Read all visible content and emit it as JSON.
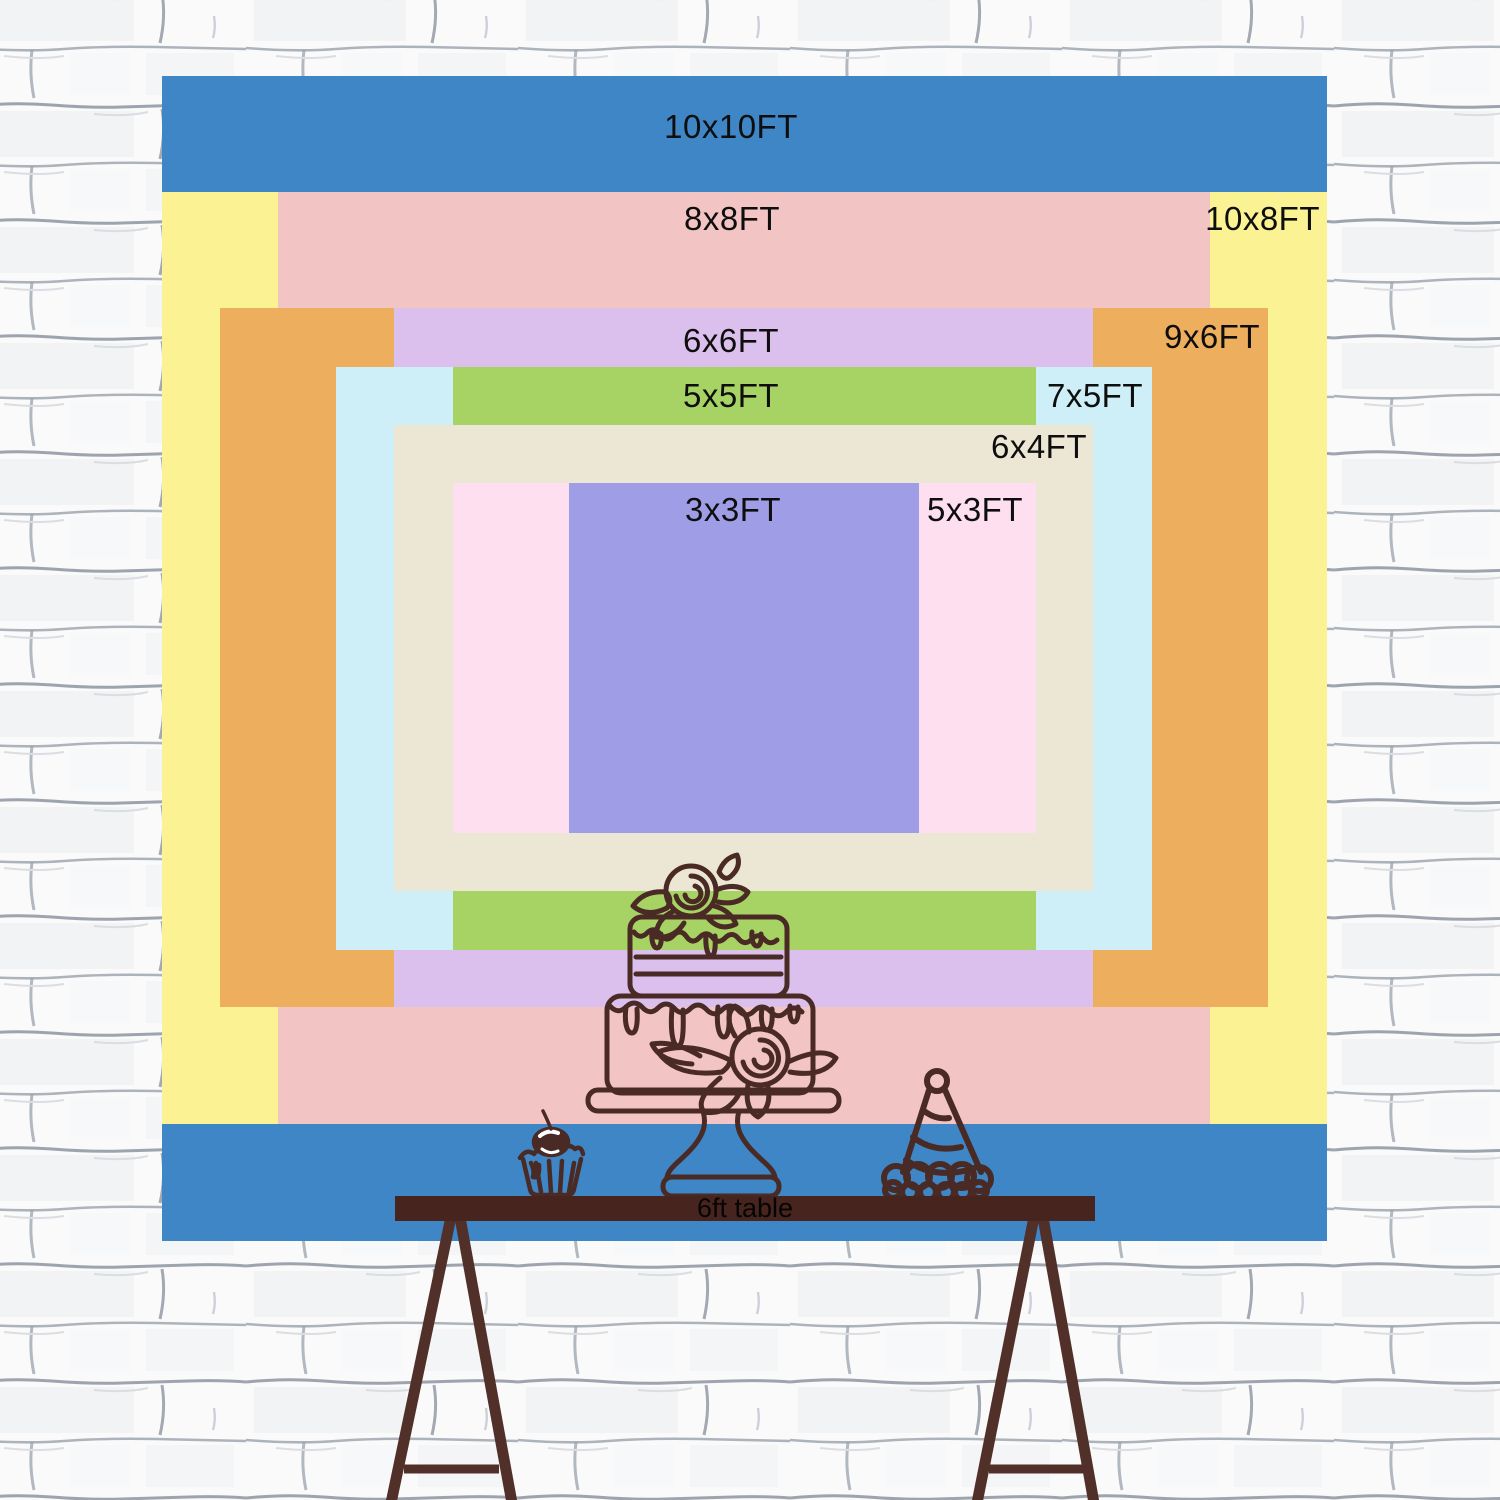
{
  "backdrop_chart": {
    "unit": "FT",
    "text_color": "#0E0E0E",
    "sizes": [
      {
        "label": "10x10FT",
        "width_ft": 10,
        "height_ft": 10,
        "color": "#3E86C5"
      },
      {
        "label": "10x8FT",
        "width_ft": 10,
        "height_ft": 8,
        "color": "#FBF294"
      },
      {
        "label": "8x8FT",
        "width_ft": 8,
        "height_ft": 8,
        "color": "#F2C5C4"
      },
      {
        "label": "9x6FT",
        "width_ft": 9,
        "height_ft": 6,
        "color": "#EDAE5E"
      },
      {
        "label": "6x6FT",
        "width_ft": 6,
        "height_ft": 6,
        "color": "#DBC0ED"
      },
      {
        "label": "7x5FT",
        "width_ft": 7,
        "height_ft": 5,
        "color": "#CEEEF8"
      },
      {
        "label": "5x5FT",
        "width_ft": 5,
        "height_ft": 5,
        "color": "#A7D364"
      },
      {
        "label": "6x4FT",
        "width_ft": 6,
        "height_ft": 4,
        "color": "#ECE6D5"
      },
      {
        "label": "5x3FT",
        "width_ft": 5,
        "height_ft": 3,
        "color": "#FDDFF0"
      },
      {
        "label": "3x3FT",
        "width_ft": 3,
        "height_ft": 3,
        "color": "#9F9DE6"
      }
    ]
  },
  "table": {
    "label": "6ft table",
    "length_ft": 6,
    "top_color": "#47251E",
    "leg_color": "#52302A"
  },
  "decorations": {
    "line_color": "#4A2A24",
    "icons": [
      "cupcake-icon",
      "birthday-cake-icon",
      "party-hat-icon"
    ]
  },
  "wall": {
    "style": "white-brick",
    "base_color": "#FAFAFB",
    "mortar_color": "#8D95A0"
  }
}
